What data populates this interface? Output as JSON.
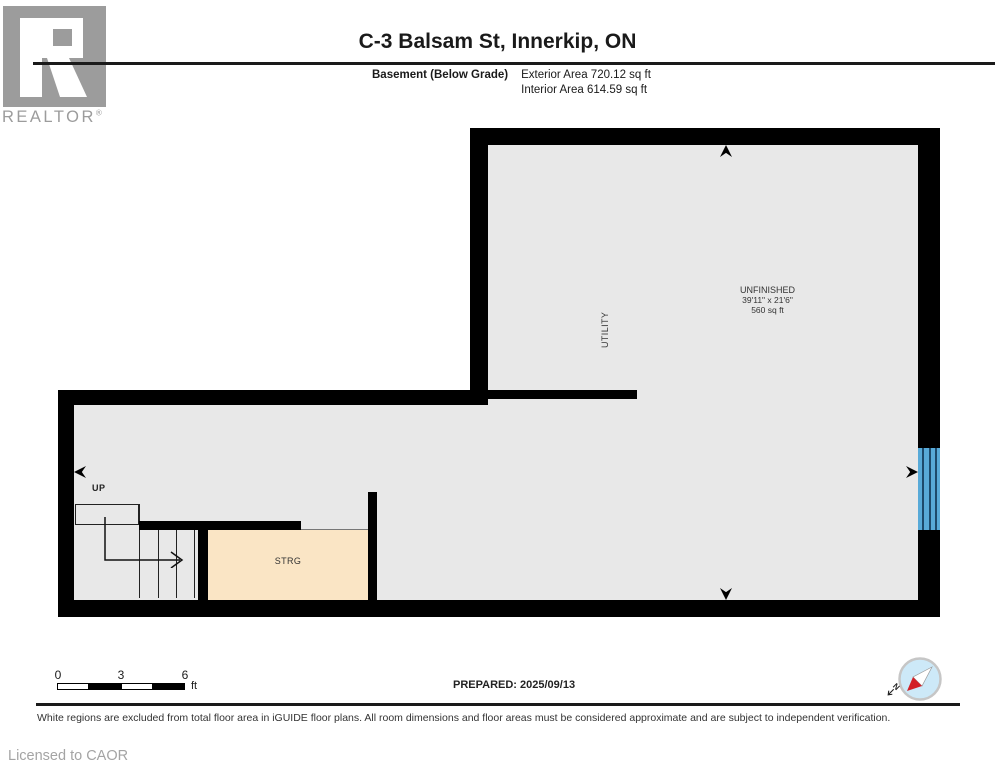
{
  "header": {
    "title": "C-3 Balsam St, Innerkip, ON",
    "floor_label": "Basement (Below Grade)",
    "exterior_area": "Exterior Area 720.12 sq ft",
    "interior_area": "Interior Area 614.59 sq ft"
  },
  "brand": {
    "name": "REALTOR",
    "registered": "®"
  },
  "plan": {
    "unfinished": {
      "name": "UNFINISHED",
      "dimensions": "39'11\" x 21'6\"",
      "area": "560 sq ft"
    },
    "utility": {
      "name": "UTILITY"
    },
    "storage": {
      "name": "STRG"
    },
    "stairs": {
      "direction": "UP"
    }
  },
  "footer": {
    "scale": {
      "tick0": "0",
      "tick1": "3",
      "tick2": "6",
      "unit": "ft"
    },
    "prepared": "PREPARED: 2025/09/13",
    "compass": {
      "north": "N"
    },
    "disclaimer": "White regions are excluded from total floor area in iGUIDE floor plans. All room dimensions and floor areas must be considered approximate and are subject to independent verification.",
    "license": "Licensed to CAOR"
  },
  "colors": {
    "wall": "#000000",
    "floor": "#e8e8e8",
    "storage_fill": "#fae5c5",
    "window_blue": "#58aad8",
    "brand_gray": "#9c9c9c",
    "compass_fill": "#cde9f8",
    "compass_red": "#d22027"
  }
}
